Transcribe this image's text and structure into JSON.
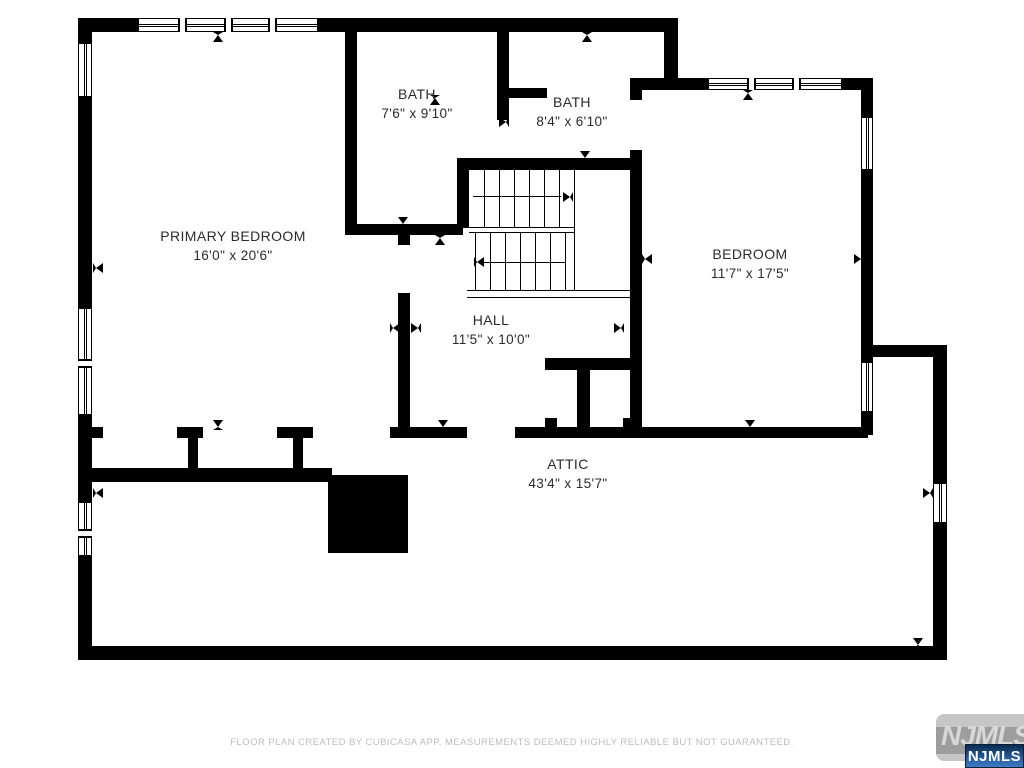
{
  "rooms": [
    {
      "id": "bath-1",
      "name": "BATH",
      "dims": "7'6\" x 9'10\""
    },
    {
      "id": "bath-2",
      "name": "BATH",
      "dims": "8'4\" x 6'10\""
    },
    {
      "id": "primary-bedroom",
      "name": "PRIMARY BEDROOM",
      "dims": "16'0\" x 20'6\""
    },
    {
      "id": "bedroom",
      "name": "BEDROOM",
      "dims": "11'7\" x 17'5\""
    },
    {
      "id": "hall",
      "name": "HALL",
      "dims": "11'5\" x 10'0\""
    },
    {
      "id": "attic",
      "name": "ATTIC",
      "dims": "43'4\" x 15'7\""
    }
  ],
  "footer": {
    "disclaimer": "FLOOR PLAN CREATED BY CUBICASA APP. MEASUREMENTS DEEMED HIGHLY RELIABLE BUT NOT GUARANTEED."
  },
  "logo": {
    "watermark_text": "NJMLS",
    "badge_text": "NJMLS"
  },
  "colors": {
    "wall": "#000000",
    "label": "#2b2b2b",
    "footer": "#bdbdbd",
    "wmbox": "#c6c6c6",
    "wmband": "#9d9d9d",
    "wmtext": "#d8d8d8",
    "badgetop": "#0b2c50",
    "badgebot": "#3c7cc9"
  }
}
